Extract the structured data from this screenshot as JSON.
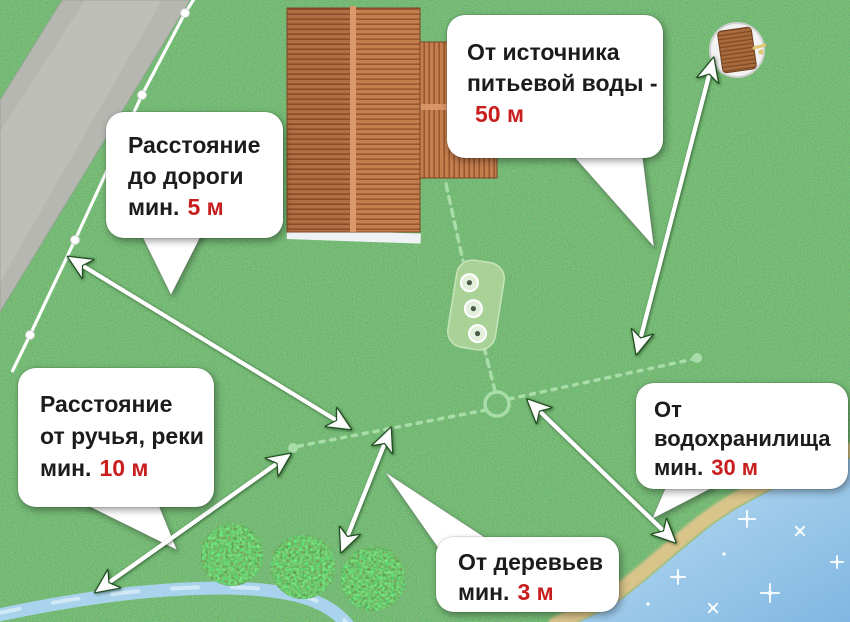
{
  "callouts": {
    "source": {
      "line1": "От источника",
      "line2": "питьевой воды -",
      "value_prefix": "",
      "value": "50 м"
    },
    "road": {
      "line1": "Расстояние",
      "line2": "до дороги",
      "value_prefix": "мин.",
      "value": "5 м"
    },
    "stream": {
      "line1": "Расстояние",
      "line2": "от ручья, реки",
      "value_prefix": "мин.",
      "value": "10 м"
    },
    "reservoir": {
      "line1": "От",
      "line2": "водохранилища",
      "value_prefix": "мин.",
      "value": "30 м"
    },
    "trees": {
      "line1": "От деревьев",
      "line2": "",
      "value_prefix": "мин.",
      "value": "3 м"
    }
  },
  "colors": {
    "accent_red": "#c81e1e",
    "label_text": "#1c1c1c",
    "label_bg": "#ffffff",
    "grass_green": "#2e7d2e",
    "pipe_green": "#a8dca8",
    "roof_terracotta": "#c07a4a",
    "road_gray": "#b7b7b2",
    "water_blue": "#8fc3e8",
    "sand_tan": "#d9c48a"
  },
  "scene_elements": {
    "house": "house-roof-top-view",
    "well": "drinking-water-well",
    "septic_tank": "septic-tank-with-manholes",
    "junction": "pipe-junction-ring",
    "road": "road-strip",
    "fence": "fence-line-with-posts",
    "stream": "stream",
    "reservoir": "reservoir-water",
    "bushes": "three-bushes",
    "arrows": [
      "road-distance",
      "well-distance",
      "stream-distance",
      "trees-distance",
      "reservoir-distance"
    ]
  }
}
